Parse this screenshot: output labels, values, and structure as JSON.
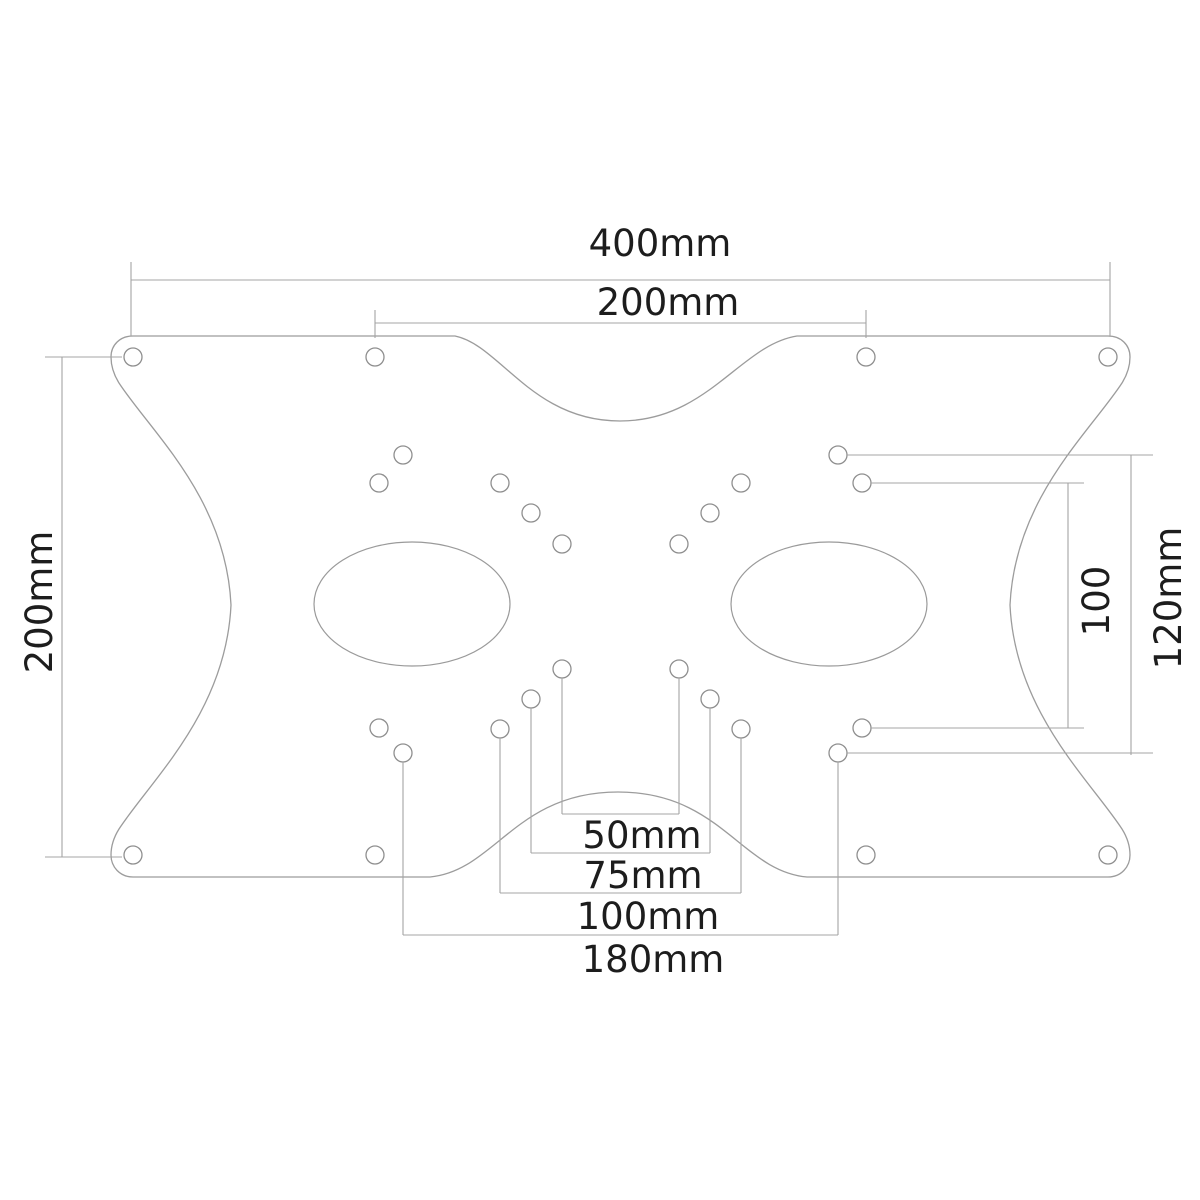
{
  "drawing": {
    "kind": "technical-dimension-drawing",
    "subject": "vesa-adapter-mounting-plate",
    "units": "mm",
    "colors": {
      "background": "#ffffff",
      "outline": "#9c9c9c",
      "holes": "#8f8f8f",
      "dimension_lines": "#a4a4a4",
      "text": "#1d1d1d"
    },
    "labels": {
      "overall_width": "400mm",
      "upper_span": "200mm",
      "left_height": "200mm",
      "right_inner_span": "100",
      "right_outer_span": "120mm",
      "bottom_span_50": "50mm",
      "bottom_span_75": "75mm",
      "bottom_span_100": "100mm",
      "bottom_span_180": "180mm"
    },
    "plate_path": "M 133,336 L 455,336 C 500,345 532,421 620,421 C 708,421 740,345 797,336 L 1108,336 C 1121,336 1130,345 1130,357 C 1130,366 1127,375 1122,383 C 1090,432 1015,498 1010,605 C 1015,712 1090,780 1122,829 C 1127,837 1130,846 1130,855 C 1130,867 1121,877 1108,877 L 807,877 C 741,871 721,792 618,792 C 515,792 495,871 430,877 L 133,877 C 120,877 111,867 111,855 C 111,846 114,837 119,829 C 151,780 226,712 231,605 C 226,498 151,432 119,383 C 114,375 111,366 111,357 C 111,345 120,336 133,336 Z",
    "cutouts": [
      {
        "cx": 412,
        "cy": 604,
        "rx": 98,
        "ry": 62
      },
      {
        "cx": 829,
        "cy": 604,
        "rx": 98,
        "ry": 62
      }
    ],
    "holes": [
      {
        "x": 133,
        "y": 357,
        "r": 9
      },
      {
        "x": 375,
        "y": 357,
        "r": 9
      },
      {
        "x": 866,
        "y": 357,
        "r": 9
      },
      {
        "x": 1108,
        "y": 357,
        "r": 9
      },
      {
        "x": 403,
        "y": 455,
        "r": 9
      },
      {
        "x": 838,
        "y": 455,
        "r": 9
      },
      {
        "x": 379,
        "y": 483,
        "r": 9
      },
      {
        "x": 500,
        "y": 483,
        "r": 9
      },
      {
        "x": 741,
        "y": 483,
        "r": 9
      },
      {
        "x": 862,
        "y": 483,
        "r": 9
      },
      {
        "x": 531,
        "y": 513,
        "r": 9
      },
      {
        "x": 710,
        "y": 513,
        "r": 9
      },
      {
        "x": 562,
        "y": 544,
        "r": 9
      },
      {
        "x": 679,
        "y": 544,
        "r": 9
      },
      {
        "x": 562,
        "y": 669,
        "r": 9
      },
      {
        "x": 679,
        "y": 669,
        "r": 9
      },
      {
        "x": 531,
        "y": 699,
        "r": 9
      },
      {
        "x": 710,
        "y": 699,
        "r": 9
      },
      {
        "x": 500,
        "y": 729,
        "r": 9
      },
      {
        "x": 741,
        "y": 729,
        "r": 9
      },
      {
        "x": 379,
        "y": 728,
        "r": 9
      },
      {
        "x": 862,
        "y": 728,
        "r": 9
      },
      {
        "x": 403,
        "y": 753,
        "r": 9
      },
      {
        "x": 838,
        "y": 753,
        "r": 9
      },
      {
        "x": 133,
        "y": 855,
        "r": 9
      },
      {
        "x": 375,
        "y": 855,
        "r": 9
      },
      {
        "x": 866,
        "y": 855,
        "r": 9
      },
      {
        "x": 1108,
        "y": 855,
        "r": 9
      }
    ],
    "dimension_lines": [
      {
        "x1": 131,
        "y1": 280,
        "x2": 1110,
        "y2": 280,
        "kind": "dimension"
      },
      {
        "x1": 131,
        "y1": 262,
        "x2": 131,
        "y2": 336,
        "kind": "extension"
      },
      {
        "x1": 1110,
        "y1": 262,
        "x2": 1110,
        "y2": 336,
        "kind": "extension"
      },
      {
        "x1": 375,
        "y1": 323,
        "x2": 866,
        "y2": 323,
        "kind": "dimension"
      },
      {
        "x1": 375,
        "y1": 310,
        "x2": 375,
        "y2": 338,
        "kind": "extension"
      },
      {
        "x1": 866,
        "y1": 310,
        "x2": 866,
        "y2": 338,
        "kind": "extension"
      },
      {
        "x1": 62,
        "y1": 357,
        "x2": 62,
        "y2": 857,
        "kind": "dimension"
      },
      {
        "x1": 45,
        "y1": 357,
        "x2": 122,
        "y2": 357,
        "kind": "leader"
      },
      {
        "x1": 45,
        "y1": 857,
        "x2": 122,
        "y2": 857,
        "kind": "leader"
      },
      {
        "x1": 1068,
        "y1": 483,
        "x2": 1068,
        "y2": 728,
        "kind": "dimension"
      },
      {
        "x1": 871,
        "y1": 483,
        "x2": 1084,
        "y2": 483,
        "kind": "leader"
      },
      {
        "x1": 871,
        "y1": 728,
        "x2": 1084,
        "y2": 728,
        "kind": "leader"
      },
      {
        "x1": 1131,
        "y1": 455,
        "x2": 1131,
        "y2": 755,
        "kind": "dimension"
      },
      {
        "x1": 847,
        "y1": 455,
        "x2": 1153,
        "y2": 455,
        "kind": "leader"
      },
      {
        "x1": 847,
        "y1": 753,
        "x2": 1153,
        "y2": 753,
        "kind": "leader"
      },
      {
        "x1": 562,
        "y1": 678,
        "x2": 562,
        "y2": 814,
        "kind": "leader"
      },
      {
        "x1": 679,
        "y1": 678,
        "x2": 679,
        "y2": 814,
        "kind": "leader"
      },
      {
        "x1": 562,
        "y1": 814,
        "x2": 679,
        "y2": 814,
        "kind": "dimension"
      },
      {
        "x1": 531,
        "y1": 708,
        "x2": 531,
        "y2": 853,
        "kind": "leader"
      },
      {
        "x1": 710,
        "y1": 708,
        "x2": 710,
        "y2": 853,
        "kind": "leader"
      },
      {
        "x1": 531,
        "y1": 853,
        "x2": 710,
        "y2": 853,
        "kind": "dimension"
      },
      {
        "x1": 500,
        "y1": 738,
        "x2": 500,
        "y2": 893,
        "kind": "leader"
      },
      {
        "x1": 741,
        "y1": 738,
        "x2": 741,
        "y2": 893,
        "kind": "leader"
      },
      {
        "x1": 500,
        "y1": 893,
        "x2": 741,
        "y2": 893,
        "kind": "dimension"
      },
      {
        "x1": 403,
        "y1": 762,
        "x2": 403,
        "y2": 935,
        "kind": "leader"
      },
      {
        "x1": 838,
        "y1": 762,
        "x2": 838,
        "y2": 935,
        "kind": "leader"
      },
      {
        "x1": 403,
        "y1": 935,
        "x2": 838,
        "y2": 935,
        "kind": "dimension"
      }
    ]
  }
}
